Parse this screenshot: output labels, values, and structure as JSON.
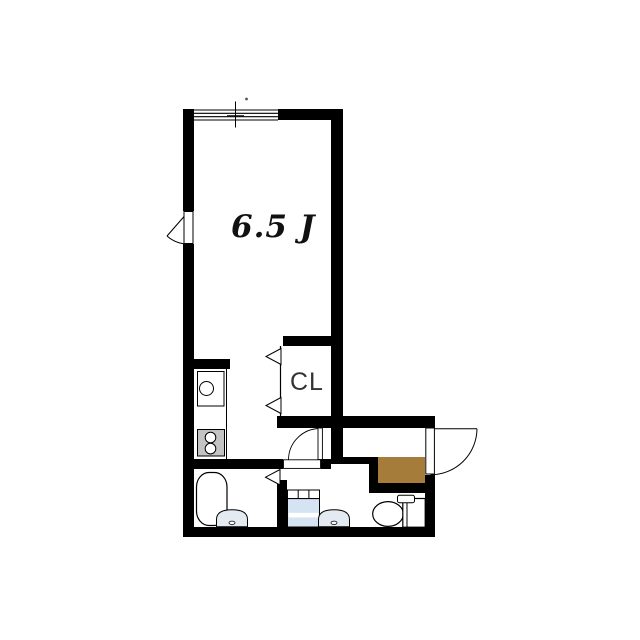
{
  "floorplan": {
    "room_label": "6.5 J",
    "closet_label": "CL",
    "colors": {
      "wall": "#000000",
      "background": "#ffffff",
      "genkan_step": "#a67c3b",
      "washer_body": "#d5e3f2",
      "basin_fill": "#e3eaf1",
      "stove_fill": "#c3c3c3",
      "fixture_fill": "#ffffff",
      "outline": "#000000",
      "room_label_color": "#111111",
      "closet_label_color": "#333333"
    },
    "fixtures": [
      "window",
      "balcony-door",
      "kitchen-counter",
      "kitchen-sink",
      "gas-stove",
      "closet-bifold-door",
      "kitchen-hall-door",
      "bathroom-folding-door",
      "bathtub",
      "washbasin",
      "washing-machine-pan",
      "toilet",
      "entry-door",
      "genkan-step"
    ]
  }
}
